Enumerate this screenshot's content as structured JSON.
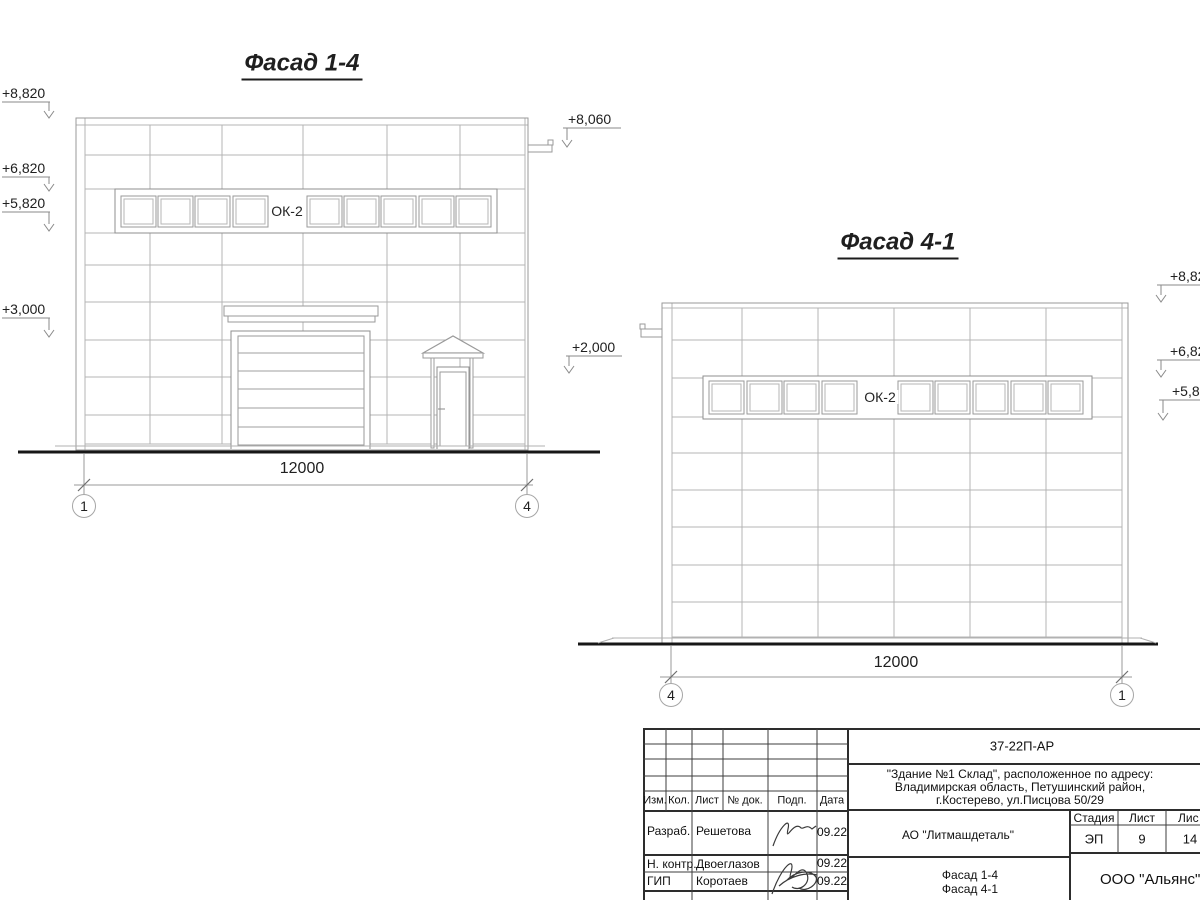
{
  "drawing": {
    "facade14": {
      "title": "Фасад 1-4",
      "window_label": "ОК-2",
      "dimension": "12000",
      "axis_left": "1",
      "axis_right": "4",
      "mark_8820": "+8,820",
      "mark_6820": "+6,820",
      "mark_5820": "+5,820",
      "mark_3000": "+3,000",
      "mark_8060": "+8,060",
      "mark_2000": "+2,000"
    },
    "facade41": {
      "title": "Фасад 4-1",
      "window_label": "ОК-2",
      "dimension": "12000",
      "axis_left": "4",
      "axis_right": "1",
      "mark_8820": "+8,82",
      "mark_6820": "+6,82",
      "mark_5820": "+5,8"
    }
  },
  "title_block": {
    "doc_number": "37-22П-АР",
    "address_line1": "\"Здание №1 Склад\", расположенное по адресу:",
    "address_line2": "Владимирская область, Петушинский район,",
    "address_line3": "г.Костерево, ул.Писцова 50/29",
    "col_izm": "Изм.",
    "col_kol": "Кол.",
    "col_list": "Лист",
    "col_doc": "№ док.",
    "col_podp": "Подп.",
    "col_data": "Дата",
    "row1_role": "Разраб.",
    "row1_name": "Решетова",
    "row1_date": "09.22",
    "row2_role": "Н. контр.",
    "row2_name": "Двоеглазов",
    "row2_date": "09.22",
    "row3_role": "ГИП",
    "row3_name": "Коротаев",
    "row3_date": "09.22",
    "client": "АО \"Литмашдеталь\"",
    "stage_label": "Стадия",
    "sheet_label": "Лист",
    "sheets_label": "Лис",
    "stage": "ЭП",
    "sheet_number": "9",
    "sheets_total": "14",
    "drawing_name1": "Фасад 1-4",
    "drawing_name2": "Фасад 4-1",
    "company": "ООО \"Альянс\""
  }
}
